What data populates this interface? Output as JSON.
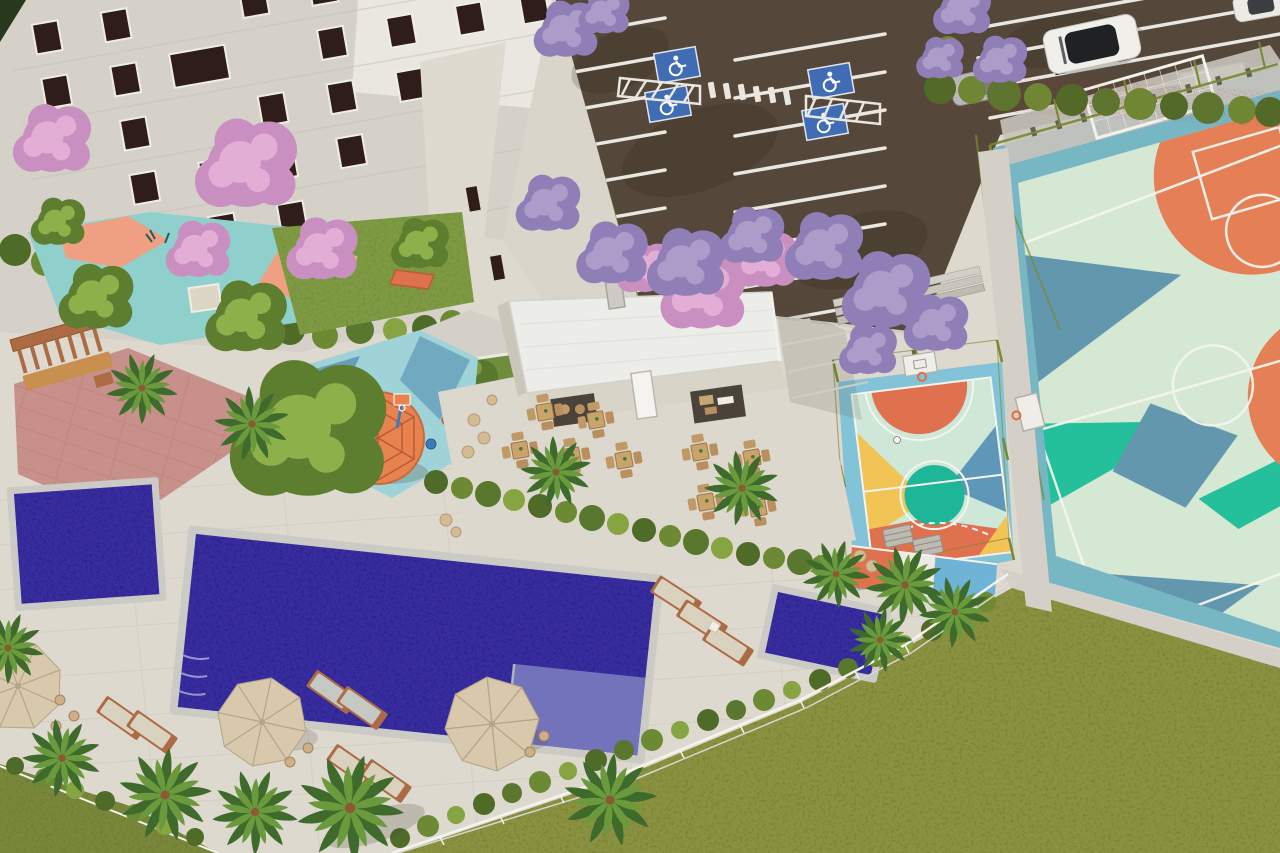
{
  "image": {
    "kind": "aerial-3d-architectural-render",
    "subject": "residential condominium leisure area with pools, sports courts, playground and parking",
    "visible_text": false
  },
  "palette": {
    "deck": "#ded9cf",
    "pathGray": "#d4d0c7",
    "deckLine": "#8d887e",
    "asphalt": "#55483a",
    "asphaltShadow": "#241c12",
    "stripeWhite": "#e9e7e0",
    "handicapBlue": "#3f6cb3",
    "lawn": "#8a9140",
    "lawnDark": "#5e6a2a",
    "grassPatch": "#7d9a43",
    "hedgeDark": "#4e6b28",
    "hedgeMid": "#6b8a33",
    "hedgeLight": "#86a441",
    "redFlower": "#c43a35",
    "treeGreen": "#5d7d2f",
    "treeGreenLight": "#8db04a",
    "pinkTree": "#c98fc0",
    "pinkTreeLight": "#e3aed6",
    "purpleTree": "#8f7fb6",
    "purpleTreeLight": "#ab9cca",
    "water": "#362b9e",
    "waterDark": "#221a6b",
    "waterLight": "#7a71d2",
    "coping": "#cbcac4",
    "poolLedge": "#7e80c1",
    "courtMint": "#d4e8d4",
    "courtSlate": "#6397ae",
    "courtTeal": "#23c09b",
    "courtOrange": "#e57f56",
    "courtBand": "#77b6c3",
    "fenceOlive": "#78892f",
    "kidsCourtBlue": "#83c3d7",
    "kidsCourtMint": "#cfe7d6",
    "kidsCourtTeal": "#1db699",
    "kidsCourtYellow": "#f2c355",
    "kidsCourtOrange": "#e0714e",
    "playSteel": "#5e97b8",
    "playTeal": "#8fd0cd",
    "playOrange": "#efa083",
    "playBlue": "#9fd3d8",
    "domeOrange": "#e8824f",
    "domeLine": "#b85c35",
    "wallMain": "#d5d1c8",
    "wallLight": "#eae8e1",
    "wallWing": "#dedacf",
    "windowDark": "#2e1d18",
    "windowFrame": "#f0ede6",
    "roofWhite": "#ececE8",
    "doorWhite": "#f4f3ef",
    "openingDark": "#3e362e",
    "woodBrown": "#ad6b44",
    "woodLight": "#c98f4e",
    "tanFurniture": "#caa36b",
    "cushionBeige": "#d9d2bf",
    "cushionGray": "#c6c9c3",
    "umbrellaBeige": "#d8c8ac",
    "umbrellaRib": "#b5a489",
    "pinkPaving": "#c8908a",
    "pavingLine": "#b77d76",
    "shadow": "#4f4a42"
  },
  "objects": {
    "apartment_building": {
      "visible_floors": 4,
      "windows_placed": 25,
      "wing_windows": 2
    },
    "clubhouse": {
      "roof_vents": 2,
      "terrace_table_sets": 9,
      "door": "single white door"
    },
    "parking_lot": {
      "accessible_spaces": 4,
      "crosswalk_dashes": 6,
      "cars": [
        {
          "type": "suv",
          "color": "white",
          "roof": "black"
        },
        {
          "type": "car",
          "color": "gray"
        },
        {
          "type": "car",
          "color": "white",
          "partial": true
        }
      ],
      "basketball_hoop": true
    },
    "multisport_court": {
      "surface_colors": [
        "mint",
        "slate-blue",
        "teal",
        "orange"
      ],
      "features": [
        "soccer-goal",
        "bleachers",
        "perimeter-fence",
        "side-basketball-hoop"
      ]
    },
    "kids_court": {
      "features": [
        "mini-basketball-hoop",
        "picnic-tables",
        "soccer-ball",
        "painted-geometric-surface"
      ]
    },
    "playground": {
      "features": [
        "climbing-dome",
        "sandbox",
        "toy-hoop",
        "spring-riders",
        "pergola-bench",
        "pink-paved-path"
      ]
    },
    "pet_area": {
      "features": [
        "agility-tunnel",
        "agility-ramp"
      ]
    },
    "pools": [
      {
        "name": "main-pool",
        "loungers_on_shelf": 2
      },
      {
        "name": "kids-pool"
      },
      {
        "name": "relax-pool"
      }
    ],
    "pool_deck": {
      "umbrellas": 3,
      "sun_loungers": 9,
      "palm_trees": 12
    },
    "vegetation": {
      "pink_flowering_trees": 7,
      "purple_flowering_trees": 13,
      "green_trees": 5,
      "red_flower_hedge": true
    }
  }
}
